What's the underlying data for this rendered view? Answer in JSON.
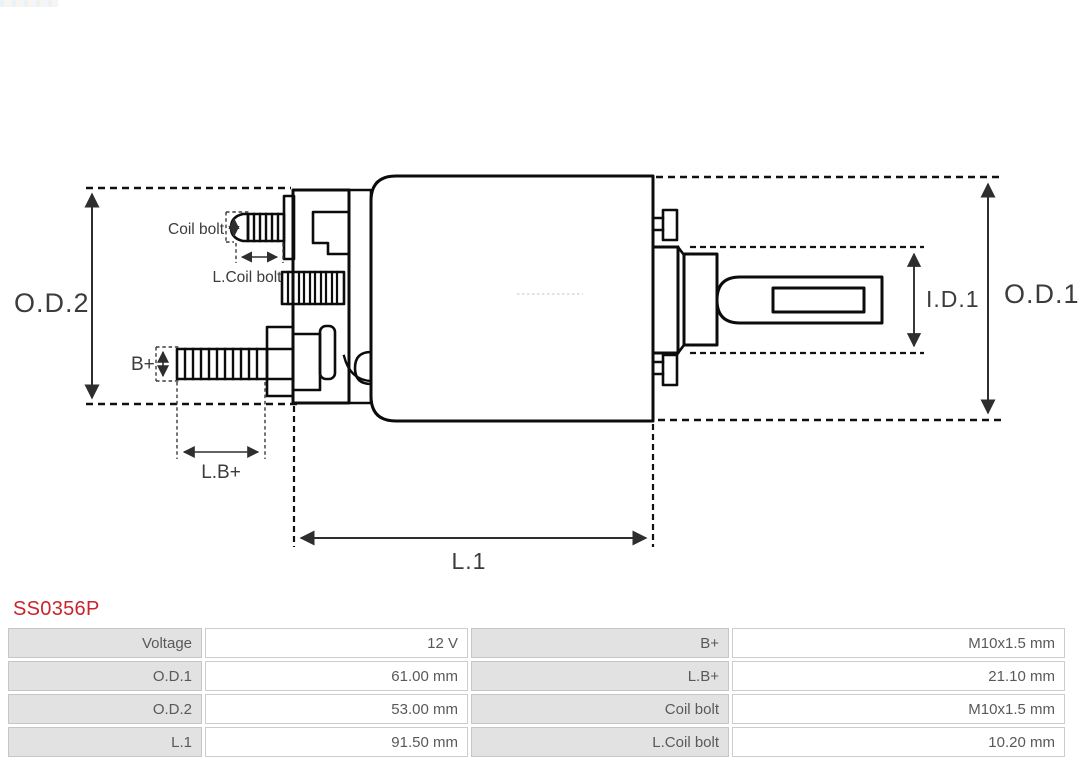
{
  "colors": {
    "part_number_red": "#c8252c",
    "drawing_ink": "#0c0c0c",
    "dimension_ink": "#2e2e2e",
    "table_text_gray": "#58595b",
    "table_label_bg": "#e2e2e2",
    "table_border": "#cccccc"
  },
  "part": {
    "number": "SS0356P"
  },
  "diagram": {
    "labels": {
      "od2": "O.D.2",
      "od1": "O.D.1",
      "id1": "I.D.1",
      "l1": "L.1",
      "b_plus": "B+",
      "lb_plus": "L.B+",
      "coil_bolt": "Coil bolt",
      "l_coil_bolt": "L.Coil bolt"
    }
  },
  "spec_table": {
    "rows": [
      {
        "label_left": "Voltage",
        "value_left": "12 V",
        "label_right": "B+",
        "value_right": "M10x1.5 mm"
      },
      {
        "label_left": "O.D.1",
        "value_left": "61.00 mm",
        "label_right": "L.B+",
        "value_right": "21.10 mm"
      },
      {
        "label_left": "O.D.2",
        "value_left": "53.00 mm",
        "label_right": "Coil bolt",
        "value_right": "M10x1.5 mm"
      },
      {
        "label_left": "L.1",
        "value_left": "91.50 mm",
        "label_right": "L.Coil bolt",
        "value_right": "10.20 mm"
      }
    ]
  }
}
